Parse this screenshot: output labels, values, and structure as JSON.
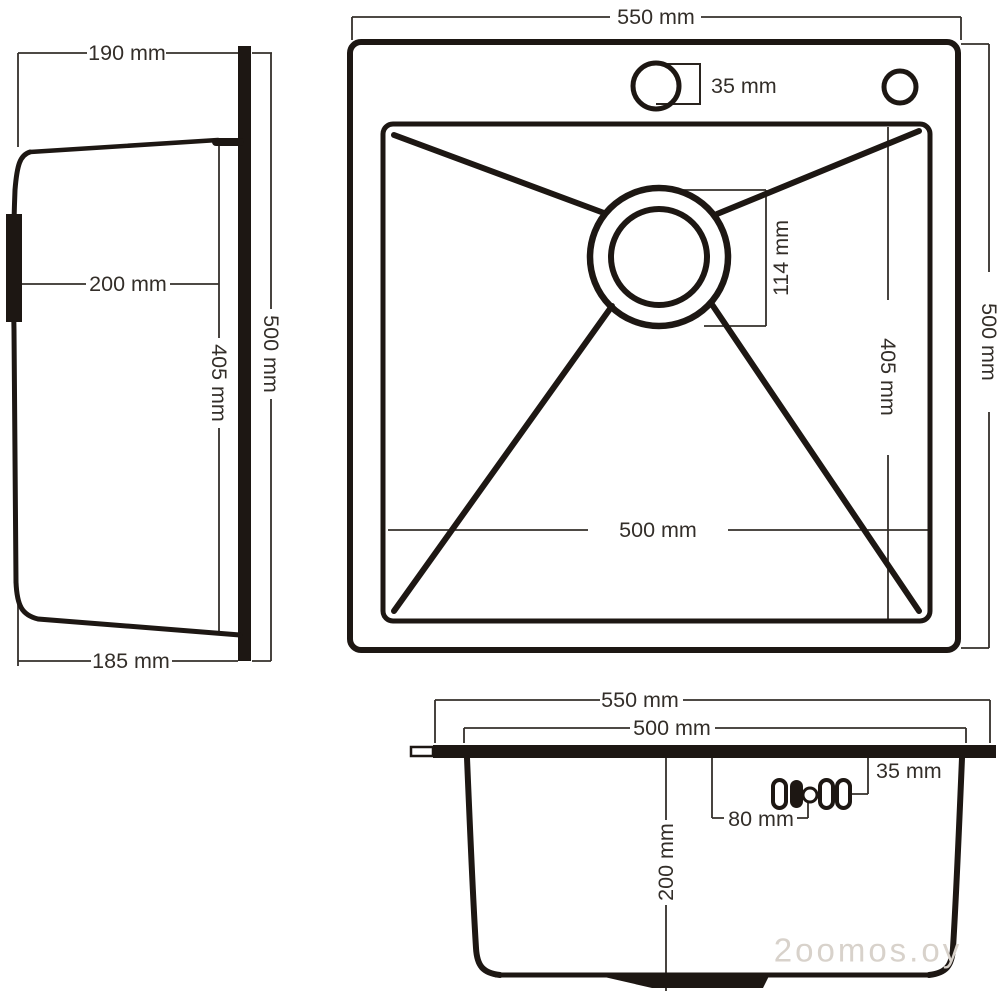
{
  "drawing_title": "kitchen sink dimensional drawing",
  "unit": "mm",
  "views": {
    "side": {
      "label": "side profile view",
      "top_width": "190 mm",
      "mid_depth": "200 mm",
      "bowl_height": "405 mm",
      "total_height": "500 mm",
      "bottom_width": "185 mm"
    },
    "top": {
      "label": "top plan view",
      "total_width": "550 mm",
      "faucet_hole": "35 mm",
      "drain_diameter": "114 mm",
      "bowl_depth": "405 mm",
      "bowl_width": "500 mm",
      "total_depth": "500 mm"
    },
    "front": {
      "label": "front section view",
      "total_width": "550 mm",
      "bowl_width": "500 mm",
      "faucet_hole": "35 mm",
      "hole_spacing": "80 mm",
      "bowl_depth": "200 mm"
    }
  },
  "watermark": "2oomos.oy"
}
